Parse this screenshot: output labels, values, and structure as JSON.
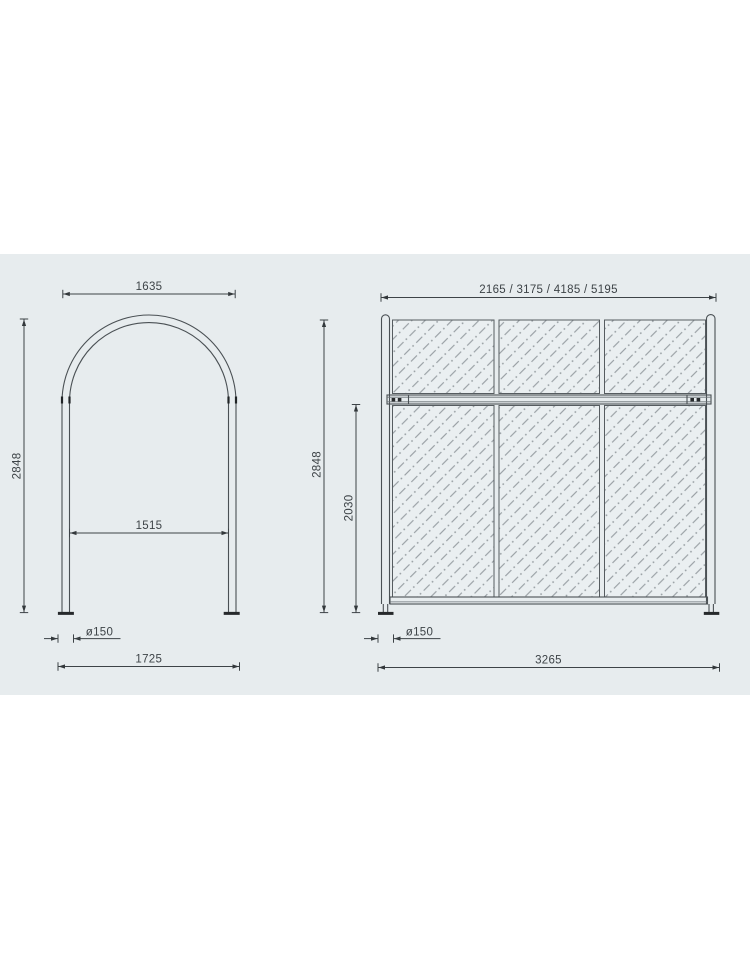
{
  "palette": {
    "page_bg": "#ffffff",
    "band_bg": "#e7ecee",
    "structure_line": "#4a5054",
    "dimension_line": "#3d4347",
    "text": "#3d4347",
    "glass_hatch": "#8d9499"
  },
  "front_view": {
    "top_width": "1635",
    "height": "2848",
    "inner_width": "1515",
    "base_plate_diameter": "ø150",
    "overall_width": "1725"
  },
  "side_view": {
    "length_options": "2165 / 3175 / 4185 / 5195",
    "height": "2848",
    "lower_section_height": "2030",
    "base_plate_diameter": "ø150",
    "overall_length": "3265"
  }
}
